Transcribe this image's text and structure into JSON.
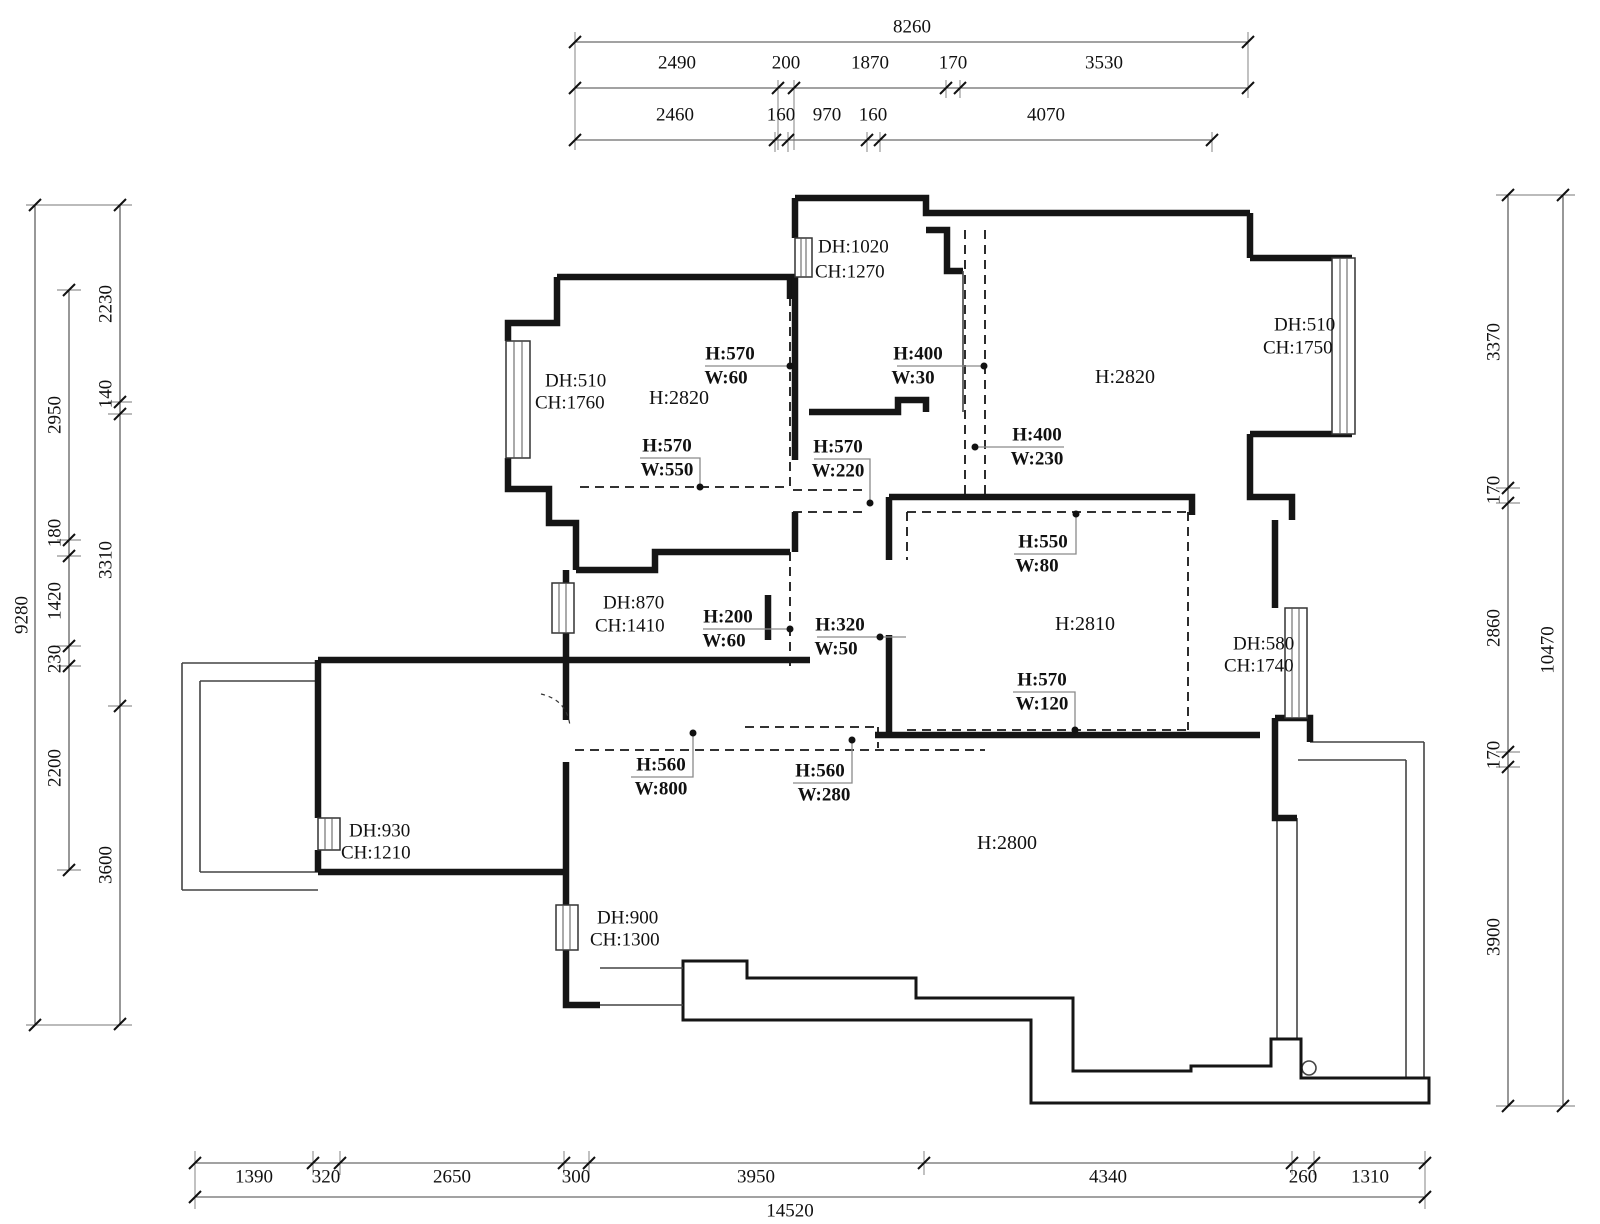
{
  "drawing_type": "floor-plan",
  "dimensions": {
    "top": {
      "total": "8260",
      "row2": [
        "2490",
        "200",
        "1870",
        "170",
        "3530"
      ],
      "row3": [
        "2460",
        "160",
        "970",
        "160",
        "4070"
      ]
    },
    "left": {
      "total": "9280",
      "chain_inner": [
        "2230",
        "140",
        "3310",
        "3600"
      ],
      "chain_mid": [
        "2950",
        "180",
        "1420",
        "230",
        "2200"
      ]
    },
    "right": {
      "total": "10470",
      "chain": [
        "3370",
        "170",
        "2860",
        "170",
        "3900"
      ]
    },
    "bottom": {
      "total": "14520",
      "chain": [
        "1390",
        "320",
        "2650",
        "300",
        "3950",
        "4340",
        "260",
        "1310"
      ]
    }
  },
  "room_heights": [
    {
      "id": "bedroom-upper-left",
      "label": "H:2820"
    },
    {
      "id": "bedroom-upper-right",
      "label": "H:2820"
    },
    {
      "id": "bedroom-mid-right",
      "label": "H:2810"
    },
    {
      "id": "living-room",
      "label": "H:2800"
    }
  ],
  "window_labels": [
    {
      "id": "entry-window",
      "dh": "DH:1020",
      "ch": "CH:1270"
    },
    {
      "id": "bay-window-right",
      "dh": "DH:510",
      "ch": "CH:1750"
    },
    {
      "id": "upper-left-window",
      "dh": "DH:510",
      "ch": "CH:1760"
    },
    {
      "id": "mid-left-window",
      "dh": "DH:870",
      "ch": "CH:1410"
    },
    {
      "id": "mid-right-window",
      "dh": "DH:580",
      "ch": "CH:1740"
    },
    {
      "id": "bottom-left-window",
      "dh": "DH:930",
      "ch": "CH:1210"
    },
    {
      "id": "living-window",
      "dh": "DH:900",
      "ch": "CH:1300"
    }
  ],
  "beam_labels": [
    {
      "id": "b1",
      "h": "H:570",
      "w": "W:60"
    },
    {
      "id": "b2",
      "h": "H:400",
      "w": "W:30"
    },
    {
      "id": "b3",
      "h": "H:570",
      "w": "W:550"
    },
    {
      "id": "b4",
      "h": "H:570",
      "w": "W:220"
    },
    {
      "id": "b5",
      "h": "H:400",
      "w": "W:230"
    },
    {
      "id": "b6",
      "h": "H:550",
      "w": "W:80"
    },
    {
      "id": "b7",
      "h": "H:200",
      "w": "W:60"
    },
    {
      "id": "b8",
      "h": "H:320",
      "w": "W:50"
    },
    {
      "id": "b9",
      "h": "H:570",
      "w": "W:120"
    },
    {
      "id": "b10",
      "h": "H:560",
      "w": "W:800"
    },
    {
      "id": "b11",
      "h": "H:560",
      "w": "W:280"
    }
  ],
  "colors": {
    "wall": "#151515",
    "dimension": "#444444",
    "leader": "#8a8a8a"
  }
}
